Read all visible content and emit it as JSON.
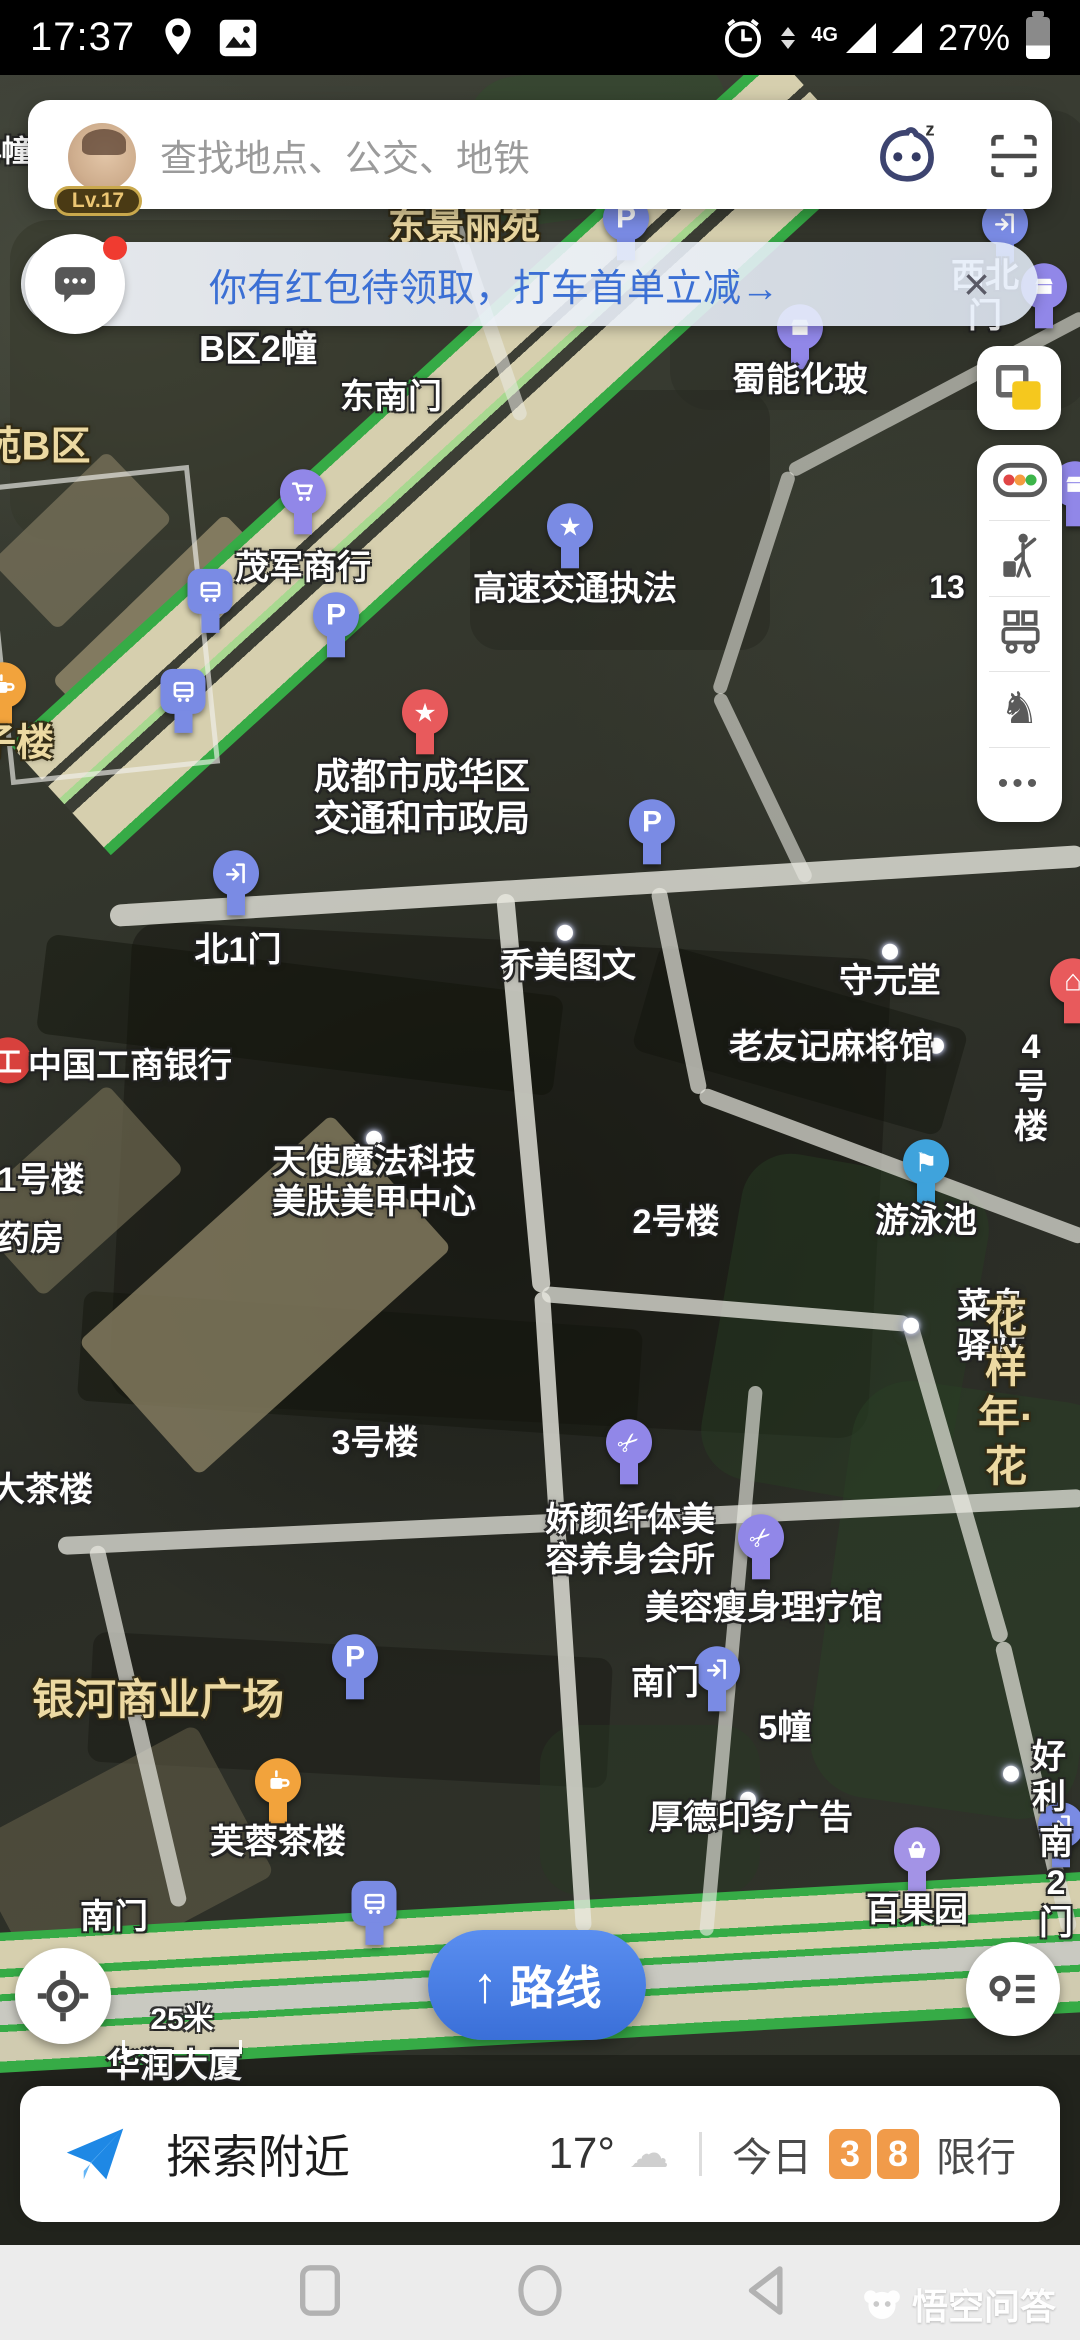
{
  "status_bar": {
    "time": "17:37",
    "network": "4G",
    "battery_percent": "27%"
  },
  "search": {
    "placeholder": "查找地点、公交、地铁",
    "user_level": "Lv.17"
  },
  "promo_banner": {
    "message": "你有红包待领取，打车首单立减→",
    "close_label": "×"
  },
  "side_toolbar": {
    "icons": [
      "traffic-conditions",
      "taxi-hail",
      "transit",
      "scenic-horse",
      "more"
    ]
  },
  "map": {
    "labels": [
      {
        "text": "4幢",
        "x": 8,
        "y": 152,
        "style": "white",
        "size": 30
      },
      {
        "text": "东景丽苑",
        "x": 464,
        "y": 227,
        "style": "tan",
        "size": 38
      },
      {
        "text": "西北门",
        "x": 985,
        "y": 296,
        "style": "white"
      },
      {
        "text": "B区2幢",
        "x": 258,
        "y": 349,
        "style": "white",
        "size": 36
      },
      {
        "text": "东南门",
        "x": 391,
        "y": 397,
        "style": "white"
      },
      {
        "text": "蜀能化玻",
        "x": 800,
        "y": 380,
        "style": "white"
      },
      {
        "text": "苑B区",
        "x": 36,
        "y": 447,
        "style": "tan",
        "size": 40
      },
      {
        "text": "茂军商行",
        "x": 303,
        "y": 568,
        "style": "white"
      },
      {
        "text": "高速交通执法",
        "x": 575,
        "y": 589,
        "style": "white"
      },
      {
        "text": "13",
        "x": 947,
        "y": 588,
        "style": "white",
        "size": 32
      },
      {
        "text": "子楼",
        "x": 16,
        "y": 744,
        "style": "tan",
        "size": 38
      },
      {
        "text": "成都市成华区\n交通和市政局",
        "x": 422,
        "y": 798,
        "style": "white",
        "size": 36
      },
      {
        "text": "北1门",
        "x": 238,
        "y": 950,
        "style": "white"
      },
      {
        "text": "乔美图文",
        "x": 568,
        "y": 966,
        "style": "white"
      },
      {
        "text": "守元堂",
        "x": 890,
        "y": 981,
        "style": "white"
      },
      {
        "text": "中国工商银行",
        "x": 130,
        "y": 1066,
        "style": "white"
      },
      {
        "text": "老友记麻将馆",
        "x": 831,
        "y": 1047,
        "style": "white"
      },
      {
        "text": "4号楼",
        "x": 1031,
        "y": 1087,
        "style": "white"
      },
      {
        "text": "1号楼",
        "x": 41,
        "y": 1180,
        "style": "white"
      },
      {
        "text": "天使魔法科技\n美肤美甲中心",
        "x": 374,
        "y": 1182,
        "style": "white"
      },
      {
        "text": "游泳池",
        "x": 926,
        "y": 1221,
        "style": "white"
      },
      {
        "text": "2号楼",
        "x": 676,
        "y": 1222,
        "style": "white"
      },
      {
        "text": "药房",
        "x": 30,
        "y": 1239,
        "style": "white"
      },
      {
        "text": "菜鸟驿站",
        "x": 991,
        "y": 1326,
        "style": "white"
      },
      {
        "text": "花样年·花",
        "x": 1006,
        "y": 1392,
        "style": "tan",
        "size": 42
      },
      {
        "text": "3号楼",
        "x": 375,
        "y": 1443,
        "style": "white"
      },
      {
        "text": "大茶楼",
        "x": 42,
        "y": 1490,
        "style": "white"
      },
      {
        "text": "娇颜纤体美\n容养身会所",
        "x": 630,
        "y": 1540,
        "style": "white"
      },
      {
        "text": "美容瘦身理疗馆",
        "x": 764,
        "y": 1608,
        "style": "white"
      },
      {
        "text": "银河商业广场",
        "x": 158,
        "y": 1700,
        "style": "tan",
        "size": 42
      },
      {
        "text": "南门",
        "x": 665,
        "y": 1683,
        "style": "white"
      },
      {
        "text": "5幢",
        "x": 785,
        "y": 1728,
        "style": "white"
      },
      {
        "text": "好利",
        "x": 1049,
        "y": 1777,
        "style": "white"
      },
      {
        "text": "厚德印务广告",
        "x": 751,
        "y": 1818,
        "style": "white"
      },
      {
        "text": "芙蓉茶楼",
        "x": 278,
        "y": 1842,
        "style": "white"
      },
      {
        "text": "百果园",
        "x": 917,
        "y": 1910,
        "style": "white"
      },
      {
        "text": "南2门",
        "x": 1056,
        "y": 1883,
        "style": "white"
      },
      {
        "text": "南门",
        "x": 114,
        "y": 1917,
        "style": "white"
      },
      {
        "text": "华润大厦",
        "x": 174,
        "y": 2066,
        "style": "white"
      }
    ],
    "pins": [
      {
        "icon": "parking",
        "x": 626,
        "y": 233
      },
      {
        "icon": "gate",
        "x": 1005,
        "y": 238
      },
      {
        "icon": "shop",
        "x": 1044,
        "y": 301
      },
      {
        "icon": "shop",
        "x": 800,
        "y": 342
      },
      {
        "icon": "cart",
        "x": 303,
        "y": 507
      },
      {
        "icon": "star-blue",
        "x": 570,
        "y": 541
      },
      {
        "icon": "bus",
        "x": 210,
        "y": 606
      },
      {
        "icon": "parking",
        "x": 336,
        "y": 630
      },
      {
        "icon": "bus",
        "x": 183,
        "y": 706
      },
      {
        "icon": "tea-orange",
        "x": 3,
        "y": 700
      },
      {
        "icon": "star-red",
        "x": 425,
        "y": 727
      },
      {
        "icon": "parking",
        "x": 652,
        "y": 837
      },
      {
        "icon": "gate",
        "x": 236,
        "y": 888
      },
      {
        "icon": "shop",
        "x": 1075,
        "y": 499
      },
      {
        "icon": "dot",
        "x": 565,
        "y": 934
      },
      {
        "icon": "dot",
        "x": 890,
        "y": 953
      },
      {
        "icon": "house-red",
        "x": 1073,
        "y": 996
      },
      {
        "icon": "icbc",
        "x": 8,
        "y": 1064
      },
      {
        "icon": "dot",
        "x": 936,
        "y": 1047
      },
      {
        "icon": "dot",
        "x": 374,
        "y": 1140
      },
      {
        "icon": "swim",
        "x": 926,
        "y": 1177
      },
      {
        "icon": "dot",
        "x": 911,
        "y": 1327
      },
      {
        "icon": "scissors",
        "x": 629,
        "y": 1457
      },
      {
        "icon": "scissors",
        "x": 761,
        "y": 1552
      },
      {
        "icon": "gate",
        "x": 717,
        "y": 1684
      },
      {
        "icon": "dot",
        "x": 748,
        "y": 1801
      },
      {
        "icon": "dot",
        "x": 1011,
        "y": 1775
      },
      {
        "icon": "basket",
        "x": 917,
        "y": 1865
      },
      {
        "icon": "gate",
        "x": 1061,
        "y": 1840
      },
      {
        "icon": "bus",
        "x": 374,
        "y": 1918
      },
      {
        "icon": "tea-orange",
        "x": 278,
        "y": 1796
      },
      {
        "icon": "parking",
        "x": 355,
        "y": 1672
      }
    ]
  },
  "bottom_controls": {
    "route_label": "路线",
    "scale_label": "25米"
  },
  "bottom_bar": {
    "explore": "探索附近",
    "temperature": "17°",
    "today": "今日",
    "restriction_digits": [
      "3",
      "8"
    ],
    "restriction": "限行"
  },
  "watermark": "悟空问答"
}
